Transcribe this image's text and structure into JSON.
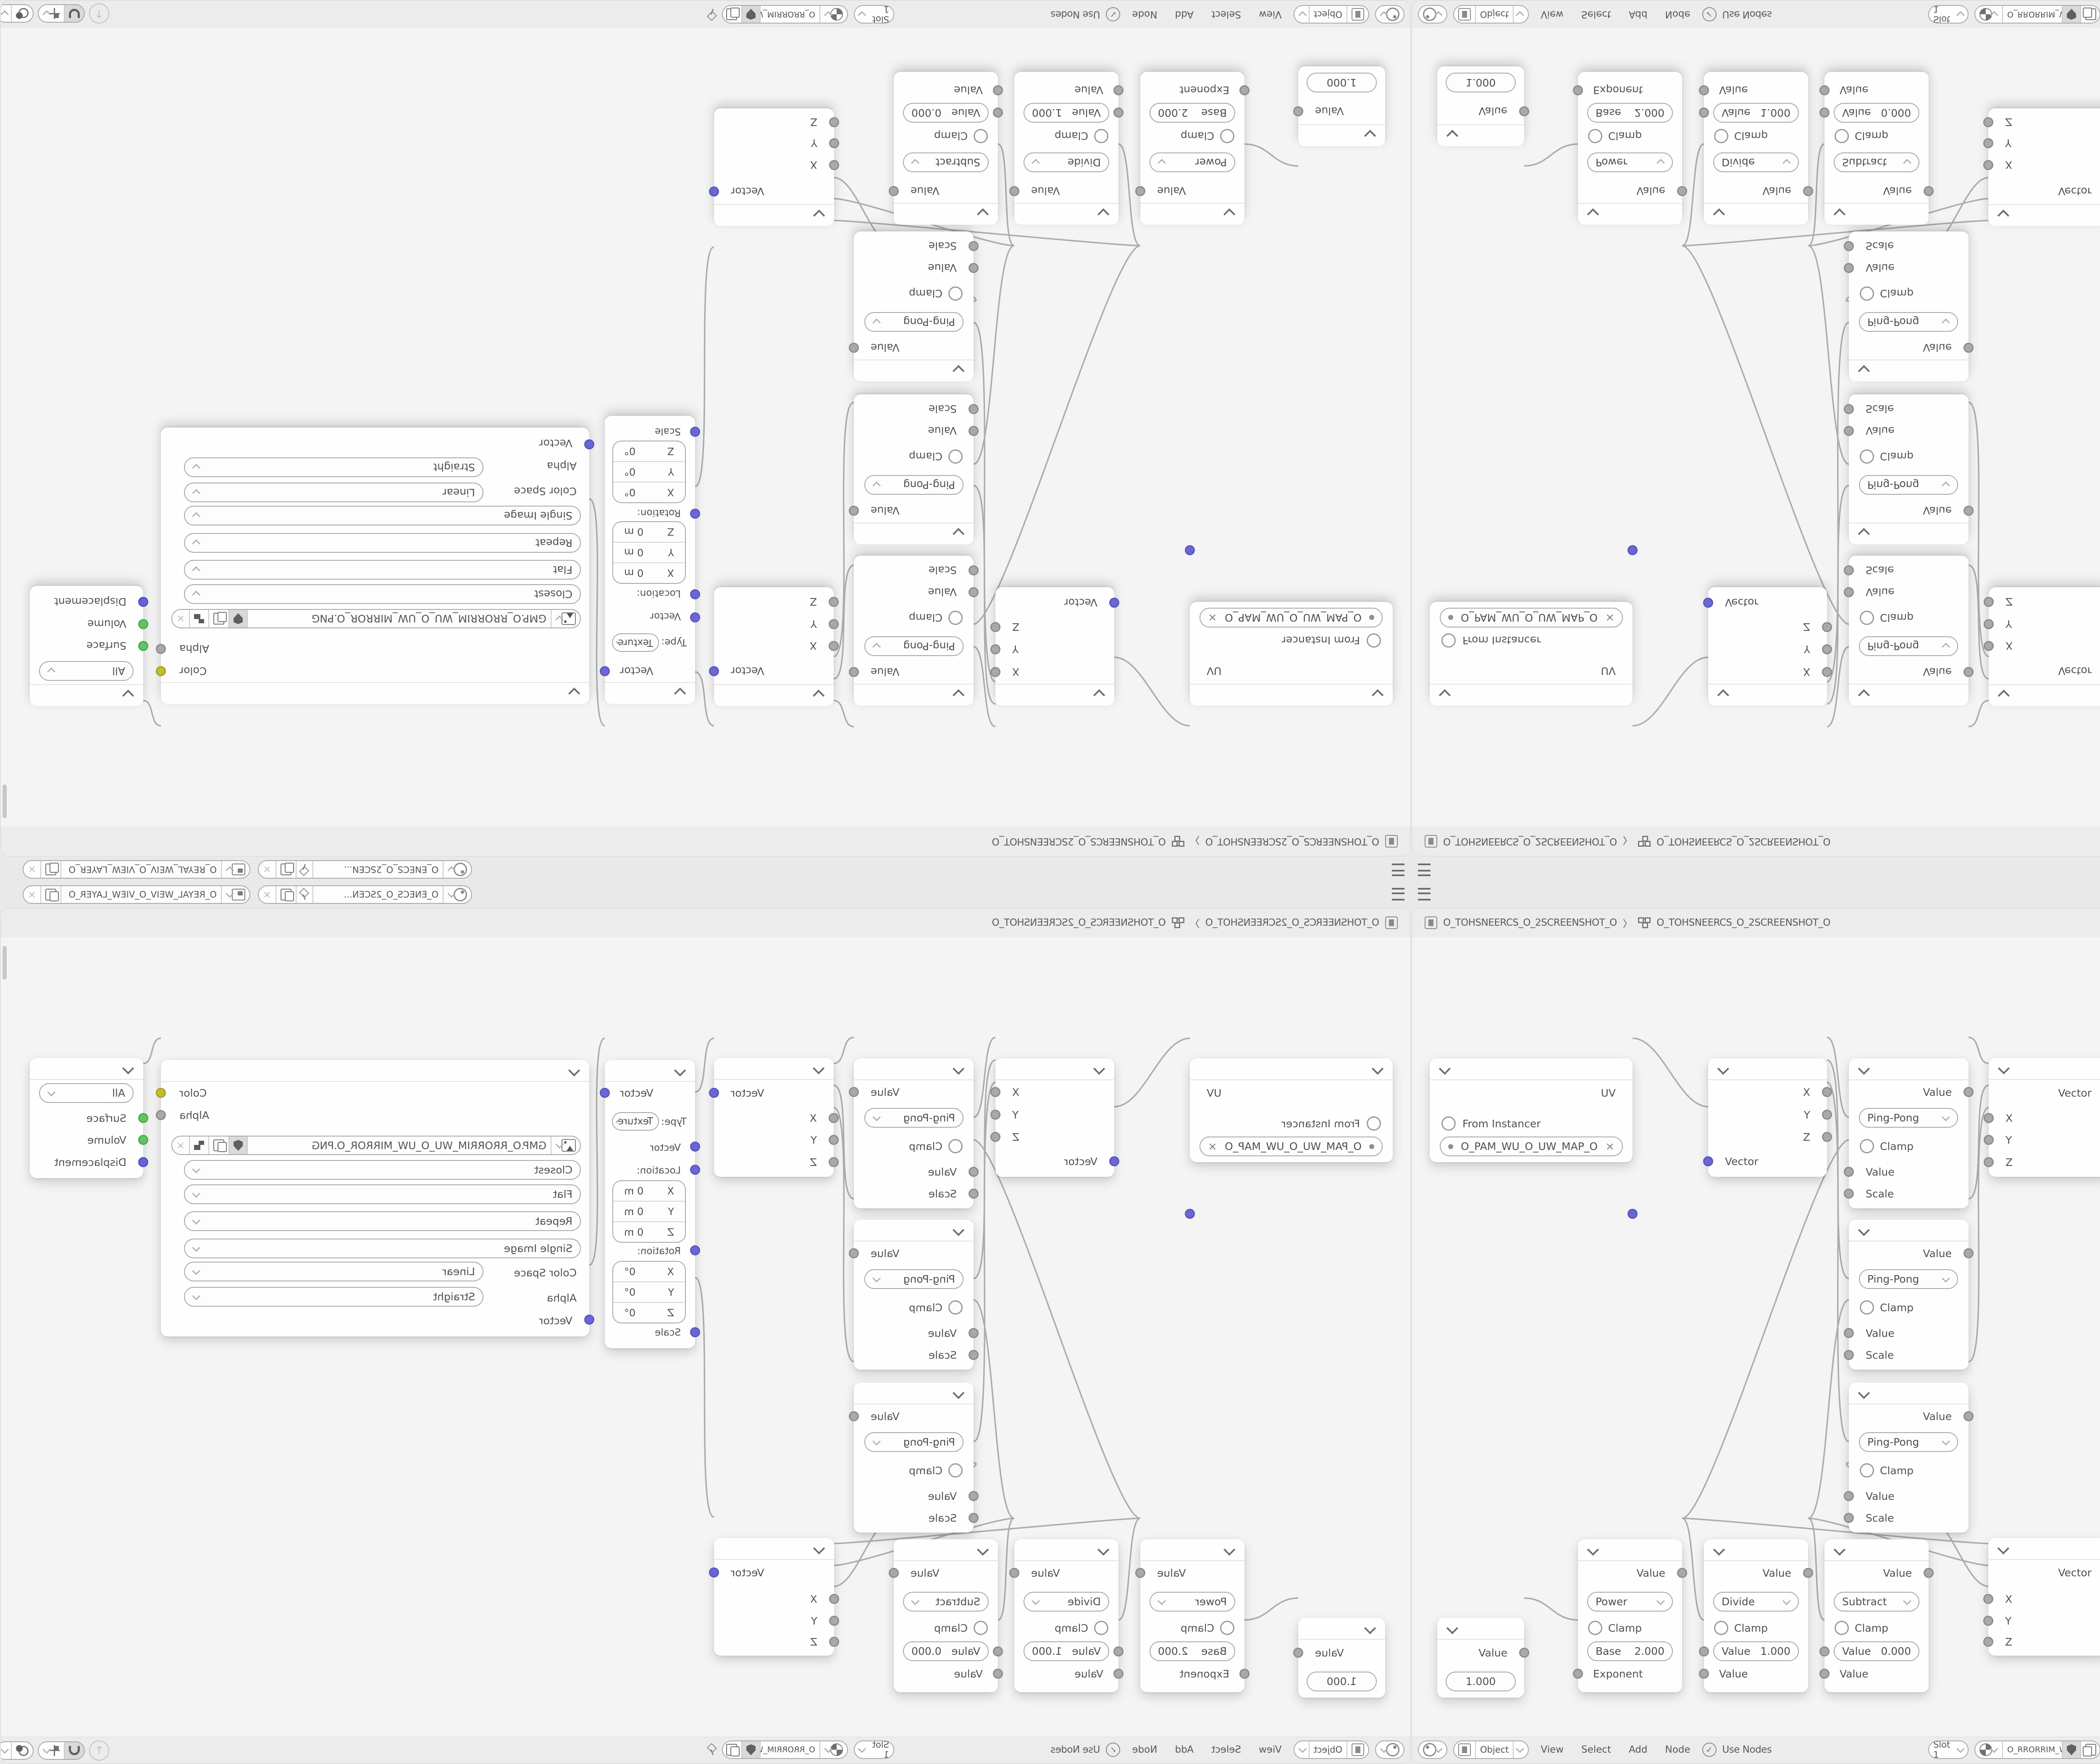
{
  "topbar": {
    "scene_label": "O_ENECS_O_2SCEN...",
    "view_layer_label": "O_REYAL_WEIV_O_VIEW_LAYER_O"
  },
  "breadcrumb": {
    "screenshot_name": "O_TOHSNEERCS_O_2SCREENSHOT_O",
    "nodetree_name": "O_TOHSNEERCS_O_2SCREENSHOT_O",
    "separator": "〉"
  },
  "nodes": {
    "uv_map": {
      "output_uv": "UV",
      "from_instancer": "From Instancer",
      "uv_name": "O_PAM_WU_O_UW_MAP_O"
    },
    "separate_xyz": {
      "out_x": "X",
      "out_y": "Y",
      "out_z": "Z",
      "in_vector": "Vector"
    },
    "math_pingpong": {
      "output": "Value",
      "operation": "Ping-Pong",
      "clamp": "Clamp",
      "in_value": "Value",
      "in_scale": "Scale"
    },
    "combine_xyz": {
      "output": "Vector",
      "in_x": "X",
      "in_y": "Y",
      "in_z": "Z"
    },
    "mapping": {
      "output": "Vector",
      "type_label": "Type:",
      "type_value": "Texture",
      "in_vector": "Vector",
      "location_label": "Location:",
      "rotation_label": "Rotation:",
      "scale_label": "Scale",
      "axis_x": "X",
      "axis_y": "Y",
      "axis_z": "Z",
      "meters": "0 m",
      "degrees": "0°"
    },
    "image_texture": {
      "out_color": "Color",
      "out_alpha": "Alpha",
      "filename": "GMP.O_RRORRIM_WU_O_UW_MIRROR_O.PNG",
      "interpolation": "Closest",
      "projection": "Flat",
      "extension": "Repeat",
      "source": "Single Image",
      "color_space_label": "Color Space",
      "color_space_value": "Linear",
      "alpha_label": "Alpha",
      "alpha_value": "Straight",
      "in_vector": "Vector"
    },
    "material_output": {
      "target": "All",
      "in_surface": "Surface",
      "in_volume": "Volume",
      "in_displacement": "Displacement"
    },
    "value_node": {
      "output": "Value",
      "value": "1.000"
    },
    "math_power": {
      "output": "Value",
      "operation": "Power",
      "clamp": "Clamp",
      "base_label": "Base",
      "base_value": "2.000",
      "in_exponent": "Exponent"
    },
    "math_divide": {
      "output": "Value",
      "operation": "Divide",
      "clamp": "Clamp",
      "value_label": "Value",
      "value_value": "1.000",
      "in_value": "Value"
    },
    "math_subtract": {
      "output": "Value",
      "operation": "Subtract",
      "clamp": "Clamp",
      "value_label": "Value",
      "value_value": "0.000",
      "in_value": "Value"
    }
  },
  "footer": {
    "object_mode": "Object",
    "menus": {
      "view": "View",
      "select": "Select",
      "add": "Add",
      "node": "Node"
    },
    "use_nodes": "Use Nodes",
    "slot": "Slot 1",
    "material_name": "O_RRORRIM_WU_O_UW_MIRROR_O"
  },
  "colors": {
    "vector_socket": "#6b66d6",
    "value_socket": "#a9a9a9",
    "color_socket": "#c2bd2e",
    "shader_socket": "#5fc463",
    "displacement_socket": "#6562d9",
    "node_bg": "#fefefe",
    "canvas_bg": "#f4f4f4",
    "bar_bg": "#e9e9e9"
  }
}
